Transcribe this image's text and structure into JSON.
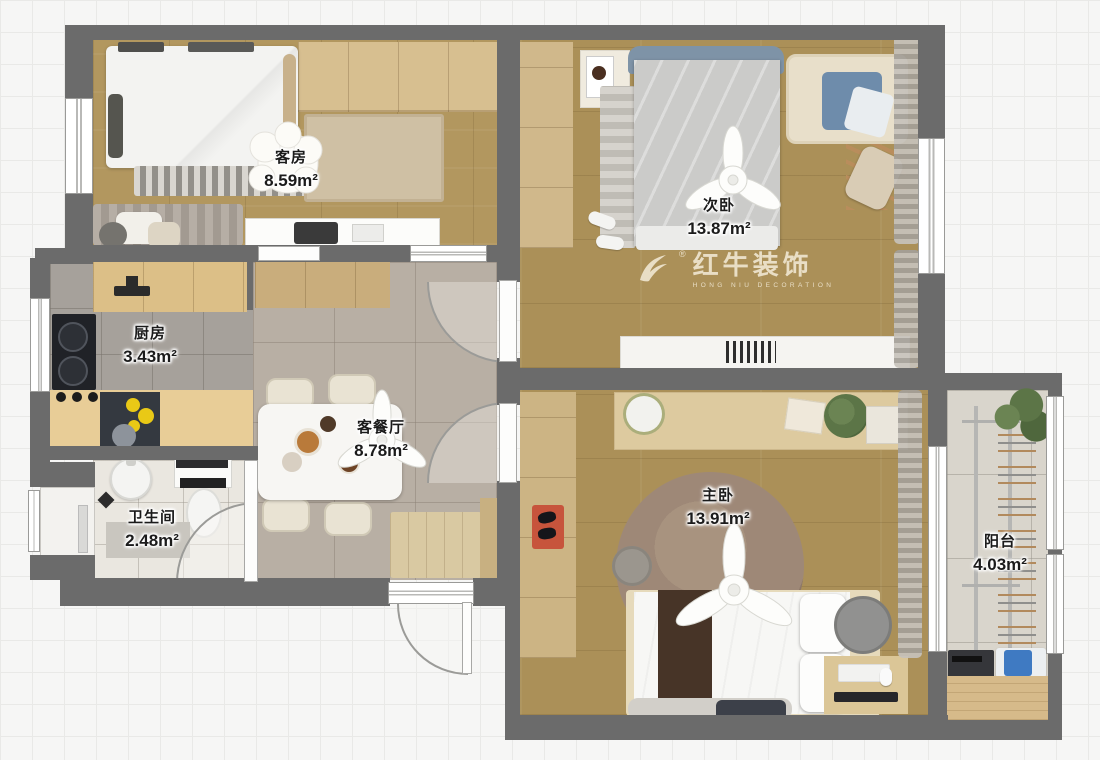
{
  "watermark": {
    "brand": "红牛装饰",
    "subtitle": "HONG NIU DECORATION",
    "registered": "®"
  },
  "rooms": [
    {
      "id": "guest-room",
      "name": "客房",
      "area": "8.59m²"
    },
    {
      "id": "second-bedroom",
      "name": "次卧",
      "area": "13.87m²"
    },
    {
      "id": "kitchen",
      "name": "厨房",
      "area": "3.43m²"
    },
    {
      "id": "living-dining-room",
      "name": "客餐厅",
      "area": "8.78m²"
    },
    {
      "id": "bathroom",
      "name": "卫生间",
      "area": "2.48m²"
    },
    {
      "id": "master-bedroom",
      "name": "主卧",
      "area": "13.91m²"
    },
    {
      "id": "balcony",
      "name": "阳台",
      "area": "4.03m²"
    }
  ],
  "colors": {
    "wall": "#6b6b6b",
    "wood_floor": "#ab9058",
    "living_tile": "#b8afa4",
    "kitchen_tile": "#a6a19b",
    "bathroom_tile": "#eae7e0",
    "balcony_tile": "#d9d5cc",
    "headboard_accent": "#7e93a7",
    "entry_mat_red": "#c7543c",
    "label_text": "#1b1b1b",
    "watermark_text": "#f6efdf"
  }
}
